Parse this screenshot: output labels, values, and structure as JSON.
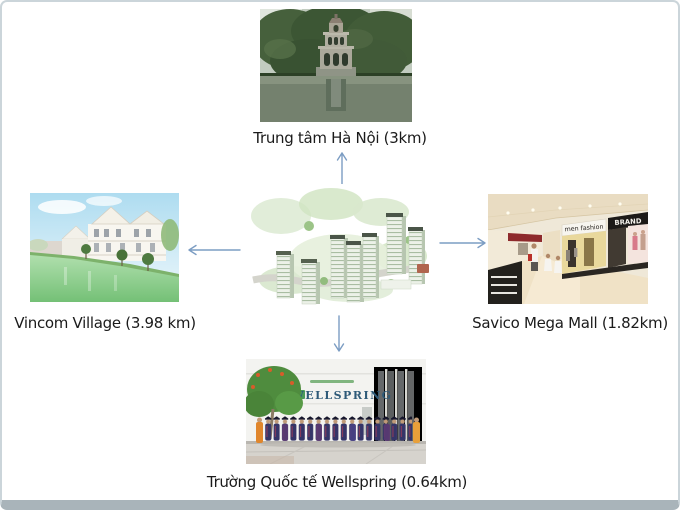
{
  "slide": {
    "background": "#ffffff",
    "frame_border_color": "#cbd5da",
    "frame_bottom_color": "#a9b4ba"
  },
  "arrows": {
    "color": "#7c9dc3",
    "directions": [
      "up",
      "left",
      "right",
      "down"
    ]
  },
  "nodes": {
    "top": {
      "label": "Trung tâm Hà Nội (3km)",
      "photo": "turtle-tower-hoan-kiem-lake-photo"
    },
    "left": {
      "label": "Vincom Village (3.98 km)",
      "photo": "lakeside-villas-photo"
    },
    "center": {
      "photo": "apartment-complex-aerial-photo"
    },
    "right": {
      "label": "Savico Mega Mall (1.82km)",
      "photo": "shopping-mall-interior-photo",
      "signs": {
        "men_fashion": "men fashion",
        "brand": "BRAND"
      }
    },
    "bottom": {
      "label": "Trường Quốc tế Wellspring (0.64km)",
      "photo": "graduation-group-photo",
      "sign": "WELLSPRING"
    }
  }
}
